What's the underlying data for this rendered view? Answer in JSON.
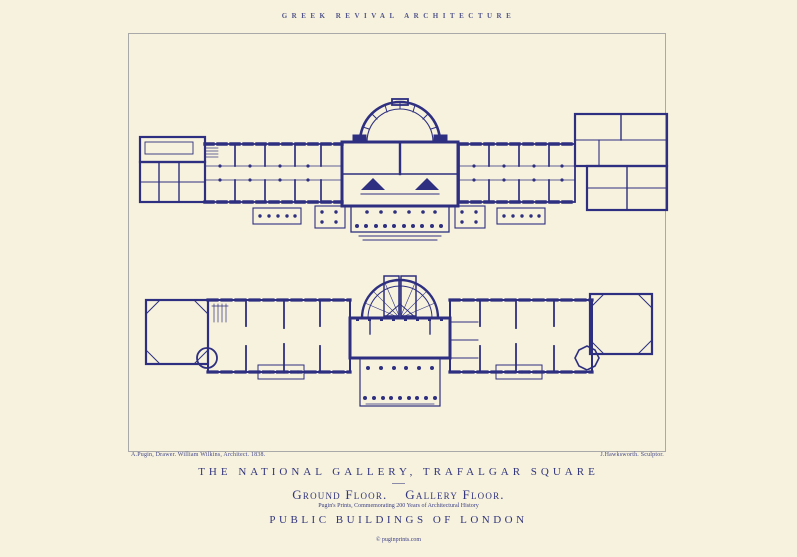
{
  "poster": {
    "colors": {
      "background": "#f6f2dd",
      "ink": "#2e2f80",
      "caption_ink": "#33357e",
      "frame": "#a9a9a9"
    },
    "header": {
      "title": "GREEK REVIVAL ARCHITECTURE"
    },
    "plate": {
      "credit_left": "A.Pugin, Drawer. William Wilkins, Architect. 1838.",
      "credit_right": "J.Hawksworth. Sculptor.",
      "plans": [
        {
          "id": "ground-floor-plan",
          "depicts": "Ground Floor"
        },
        {
          "id": "gallery-floor-plan",
          "depicts": "Gallery Floor"
        }
      ]
    },
    "captions": {
      "main_title": "THE NATIONAL GALLERY, TRAFALGAR SQUARE",
      "floor_caption": "Ground Floor.    Gallery Floor.",
      "note": "Pugin's Prints, Commemorating 200 Years of Architectural History",
      "series_title": "PUBLIC BUILDINGS OF LONDON",
      "copyright": "© puginprints.com"
    }
  }
}
